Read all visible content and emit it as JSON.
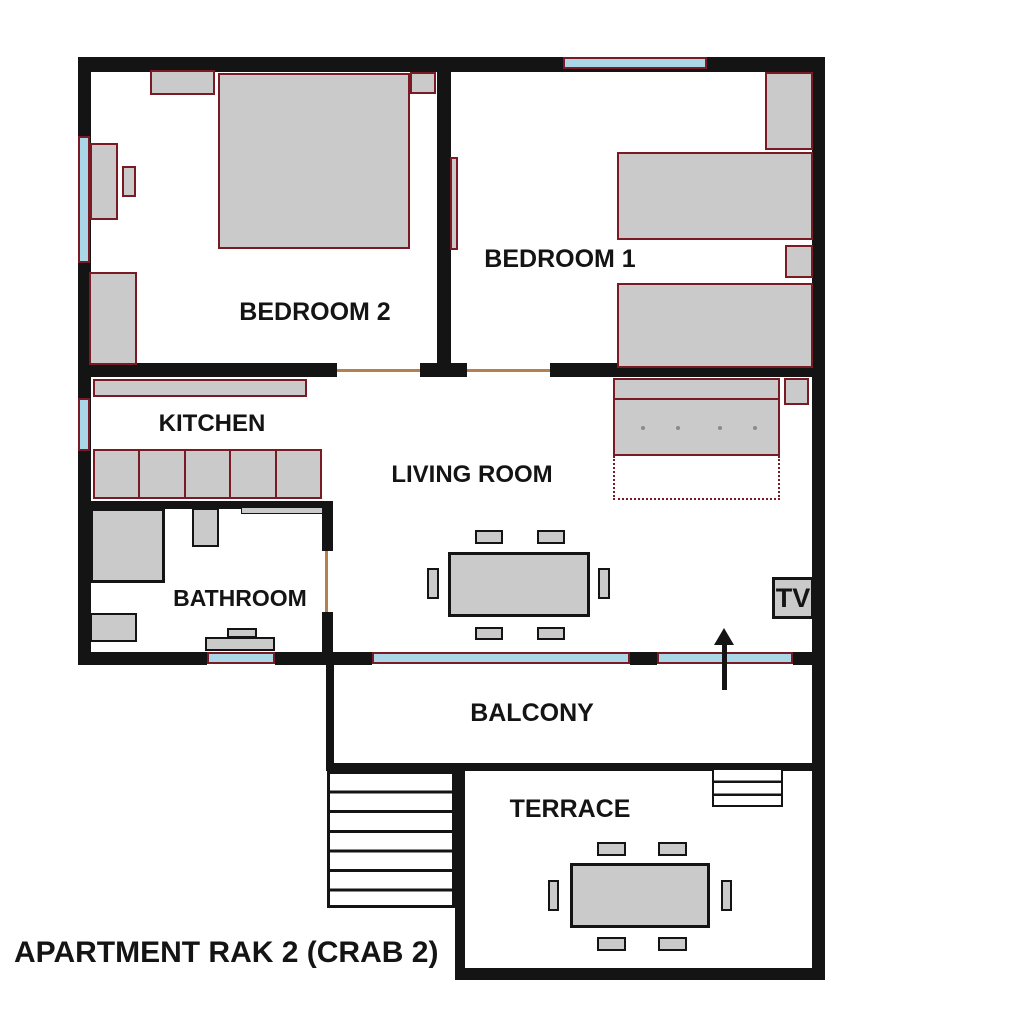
{
  "title": "APARTMENT RAK 2 (CRAB 2)",
  "rooms": {
    "bedroom2": {
      "label": "BEDROOM 2"
    },
    "bedroom1": {
      "label": "BEDROOM 1"
    },
    "kitchen": {
      "label": "KITCHEN"
    },
    "living_room": {
      "label": "LIVING ROOM"
    },
    "bathroom": {
      "label": "BATHROOM"
    },
    "balcony": {
      "label": "BALCONY"
    },
    "terrace": {
      "label": "TERRACE"
    }
  },
  "tv": {
    "label": "TV"
  },
  "icons": {
    "entrance_arrow": "up-arrow"
  },
  "colors": {
    "wall": "#141414",
    "furniture_fill": "#cacaca",
    "furniture_border": "#7a1a24",
    "window_fill": "#a9d7e8",
    "door_marker": "#b5804d",
    "background": "#ffffff",
    "text": "#141414"
  }
}
